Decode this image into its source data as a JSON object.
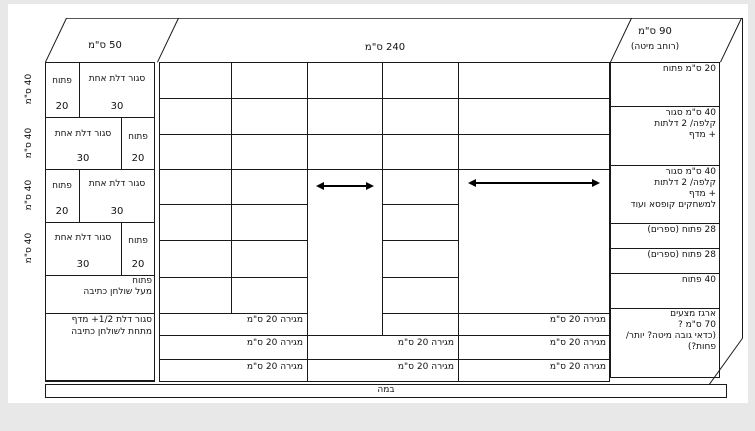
{
  "diagram": {
    "top": {
      "left": "50 ס\"מ",
      "middle": "240 ס\"מ",
      "right_line1": "90 ס\"מ",
      "right_line2": "(רוחב מיטה)"
    },
    "left_section": {
      "height_labels": [
        "40 ס\"מ",
        "40 ס\"מ",
        "40 ס\"מ",
        "40 ס\"מ"
      ],
      "rows": [
        {
          "cells": [
            {
              "label": "פתוח",
              "num": "20"
            },
            {
              "label": "סגור דלת אחת",
              "num": "30"
            }
          ]
        },
        {
          "cells": [
            {
              "label": "סגור דלת אחת",
              "num": "30"
            },
            {
              "label": "פתוח",
              "num": "20"
            }
          ]
        },
        {
          "cells": [
            {
              "label": "פתוח",
              "num": "20"
            },
            {
              "label": "סגור דלת אחת",
              "num": "30"
            }
          ]
        },
        {
          "cells": [
            {
              "label": "סגור דלת אחת",
              "num": "30"
            },
            {
              "label": "פתוח",
              "num": "20"
            }
          ]
        },
        {
          "lines": [
            "פתוח",
            "מעל שולחן כתיבה"
          ]
        },
        {
          "lines": [
            "סגור דלת 1/2+ מדף",
            "מתחת לשולחן כתיבה"
          ]
        }
      ]
    },
    "middle_section": {
      "drawer_rows": [
        {
          "cells": [
            "מגירה 20 ס\"מ",
            "מגירה 20 ס\"מ"
          ]
        },
        {
          "cells": [
            "מגירה 20 ס\"מ",
            "מגירה 20 ס\"מ",
            "מגירה 20 ס\"מ"
          ]
        },
        {
          "cells": [
            "מגירה 20 ס\"מ",
            "מגירה 20 ס\"מ",
            "מגירה 20 ס\"מ"
          ]
        }
      ]
    },
    "right_section": {
      "rows": [
        {
          "lines": [
            "20 ס\"מ פתוח"
          ]
        },
        {
          "lines": [
            "40 ס\"מ סגור",
            "קלפה/ 2 דלתות",
            "+ מדף"
          ]
        },
        {
          "lines": [
            "40 ס\"מ סגור",
            "קלפה/ 2 דלתות",
            "+ מדף",
            "למשחקים קופסא ועוד"
          ]
        },
        {
          "lines": [
            "28 פתוח (ספרים)"
          ]
        },
        {
          "lines": [
            "28 פתוח (ספרים)"
          ]
        },
        {
          "lines": [
            "40 פתוח"
          ]
        },
        {
          "lines": [
            "ארגז מצעים",
            "70 ס\"מ ?",
            "(כדאי גובה מיטה? יותר/",
            "פחות?)"
          ]
        }
      ]
    },
    "stage": {
      "label": "במה"
    },
    "colors": {
      "line": "#1a1a1a",
      "page": "#ffffff",
      "surround": "#e8e8e8"
    }
  }
}
